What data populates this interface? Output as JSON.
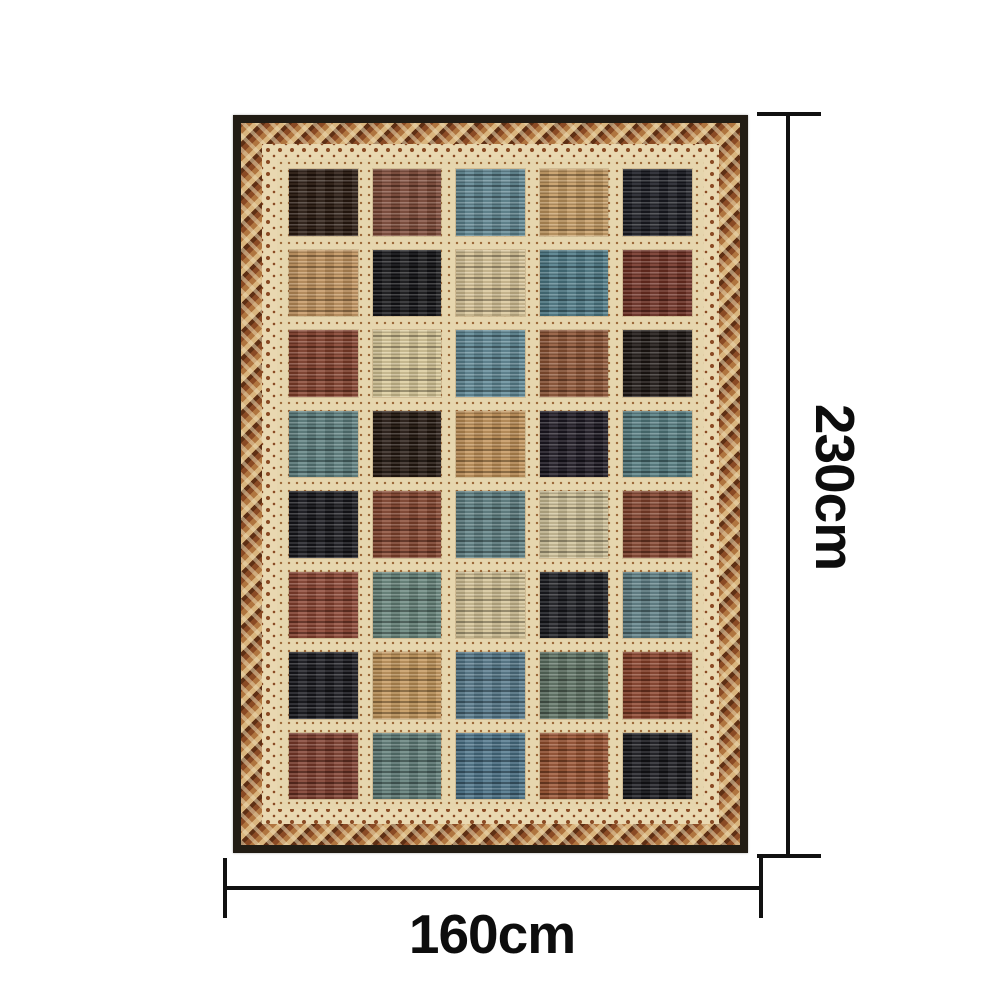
{
  "dimensions": {
    "height_label": "230cm",
    "width_label": "160cm"
  },
  "colors": {
    "bg": "#ffffff",
    "line": "#111111",
    "text": "#0d0d0d",
    "rug-outer": "#211c14",
    "zig-a": "#b0753f",
    "zig-b": "#8a4a24",
    "zig-c": "#d9b57e",
    "zig-d": "#5e2f14",
    "band-cream": "#e9d8b1",
    "band-motif": "#8a4a24",
    "field": "#e6d6ae",
    "dot": "#9a6636"
  },
  "rug": {
    "description_label": "patchwork striped area rug",
    "grid": {
      "rows": 8,
      "cols": 5,
      "colors": [
        [
          "#2a1a10",
          "#7f4937",
          "#5e8591",
          "#c59a60",
          "#1a1b22"
        ],
        [
          "#c3935c",
          "#141417",
          "#d7c395",
          "#4e7b88",
          "#713023"
        ],
        [
          "#84402b",
          "#dac998",
          "#5d8794",
          "#8f5434",
          "#1d1613"
        ],
        [
          "#5c7f7f",
          "#251810",
          "#c29156",
          "#1d1822",
          "#547d81"
        ],
        [
          "#16161b",
          "#86452e",
          "#5d7f82",
          "#cfc197",
          "#83422b"
        ],
        [
          "#8b4330",
          "#67857c",
          "#d3c294",
          "#1b1c21",
          "#5d7f85"
        ],
        [
          "#17171d",
          "#c49659",
          "#54788a",
          "#5e7263",
          "#8a4028"
        ],
        [
          "#7e3b2b",
          "#5f7d78",
          "#4b7389",
          "#9a512f",
          "#17171c"
        ]
      ]
    }
  }
}
